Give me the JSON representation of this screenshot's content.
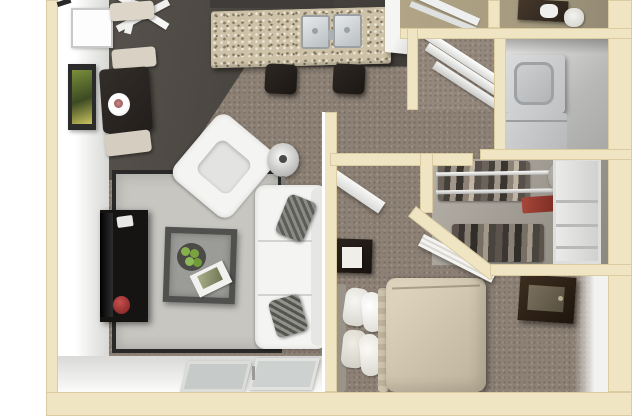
{
  "meta": {
    "title": "3D apartment floor plan render",
    "render_type": "top-down 3D floor plan",
    "visible_text": "none"
  },
  "palette": {
    "outside": "#ffffff",
    "wall-cut": "#f0e5c3",
    "wall-edge": "#d9c99c",
    "wall-face": "#ececea",
    "wood": "#4e4a45",
    "carpet": "#8d8175",
    "rug": "#c7c6c1",
    "rug-border": "#2a2927",
    "granite": "#cdc2a8",
    "steel": "#d8dbdd",
    "darkwood": "#26211d",
    "whitefurn": "#f4f4f2",
    "bedding": "#d3c8b2",
    "appliance": "#c9cbcd",
    "bathwall": "#b1a586",
    "closetbg": "#a9a49c",
    "red": "#9e2f2f",
    "green": "#86b04c"
  },
  "rooms": [
    {
      "name": "dining-area",
      "floor": "dark wood",
      "contents": [
        "dining-table",
        "dinner-plate",
        "dining-benches",
        "sideboard",
        "wall-art",
        "window",
        "ceiling-fan"
      ]
    },
    {
      "name": "kitchen",
      "floor": "dark wood",
      "contents": [
        "granite-breakfast-bar",
        "double-stainless-sink",
        "two-bar-stools"
      ]
    },
    {
      "name": "living-room",
      "floor": "brown carpet",
      "contents": [
        "area-rug",
        "white-sofa",
        "white-armchair",
        "floor-lamp",
        "glass-coffee-table",
        "fruit-bowl",
        "magazine",
        "tv-console",
        "tv",
        "red-vase",
        "patio-sliding-door"
      ]
    },
    {
      "name": "bedroom",
      "floor": "brown carpet",
      "contents": [
        "bed",
        "pillows",
        "nightstand",
        "notepad",
        "dresser-with-mirror",
        "open-door"
      ]
    },
    {
      "name": "walk-in-closet",
      "contents": [
        "clothes-rods",
        "hanging-clothes",
        "hat-box",
        "shelf-unit",
        "red-folded-item",
        "louver-door"
      ]
    },
    {
      "name": "laundry-closet",
      "contents": [
        "stacked-washer-dryer"
      ]
    },
    {
      "name": "bathroom",
      "contents": [
        "vanity",
        "sink",
        "toilet",
        "shower-door"
      ]
    },
    {
      "name": "shelf-nook",
      "contents": [
        "wire-shelves"
      ]
    }
  ]
}
